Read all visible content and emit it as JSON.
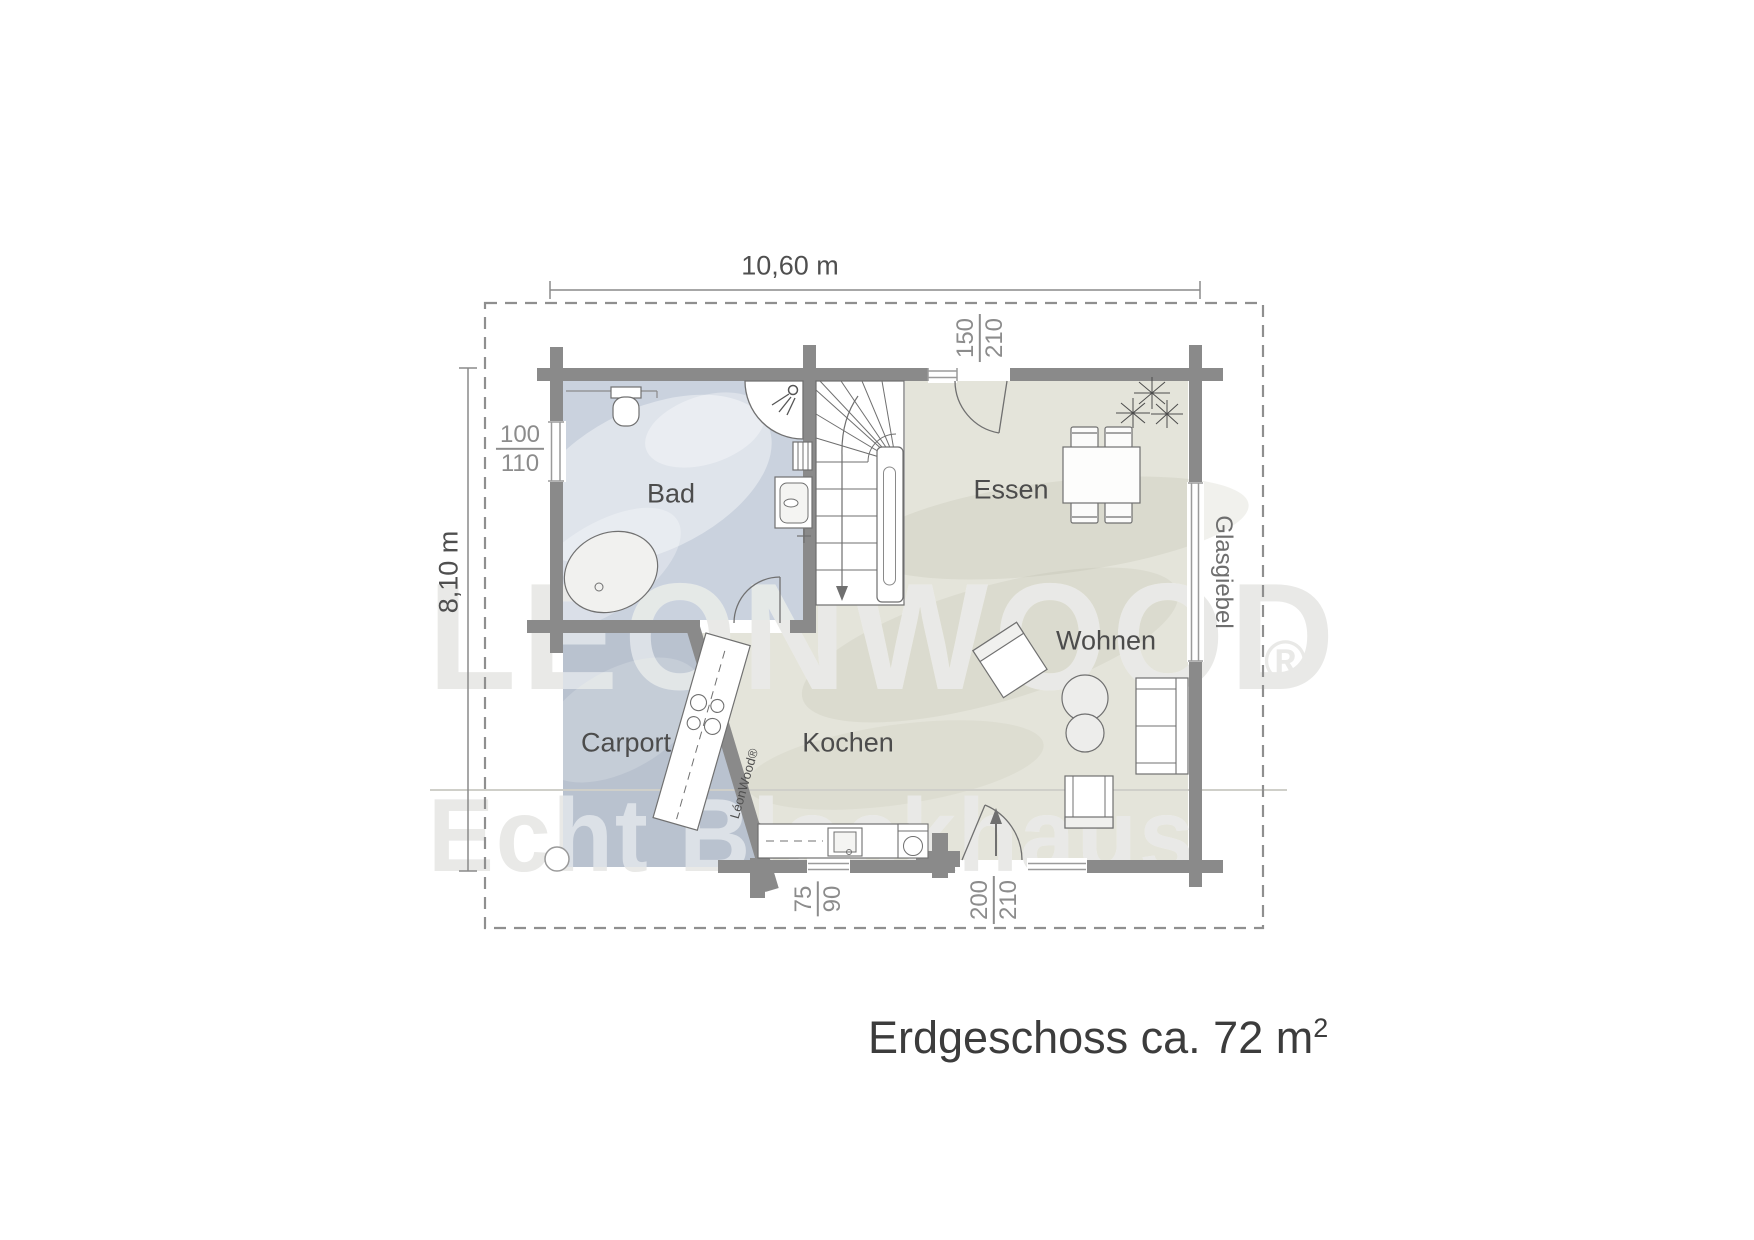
{
  "title": {
    "text": "Erdgeschoss ca. 72 m",
    "sup": "2"
  },
  "dimensions": {
    "overall_width": "10,60 m",
    "overall_height": "8,10 m"
  },
  "rooms": {
    "bad": {
      "label": "Bad"
    },
    "essen": {
      "label": "Essen"
    },
    "wohnen": {
      "label": "Wohnen"
    },
    "kochen": {
      "label": "Kochen"
    },
    "carport": {
      "label": "Carport"
    }
  },
  "openings": {
    "left_window": {
      "num": "100",
      "den": "110"
    },
    "top_terrace_door": {
      "num": "150",
      "den": "210"
    },
    "kitchen_window": {
      "num": "75",
      "den": "90"
    },
    "entrance_door": {
      "num": "200",
      "den": "210"
    }
  },
  "labels": {
    "glass_gable": "Glasgiebel"
  },
  "watermark": {
    "brand": "LEONWOOD",
    "slogan": "Echt Blockhaus",
    "registered": "®",
    "counter_brand": "LéonWood®"
  },
  "colors": {
    "wall": "#8a8a8a",
    "bath_floor": "#cad2de",
    "carport_floor": "#b9c2cf",
    "living_floor": "#e4e4da",
    "dimension_text": "#8c8c8c",
    "label_text": "#4c4c4c"
  }
}
